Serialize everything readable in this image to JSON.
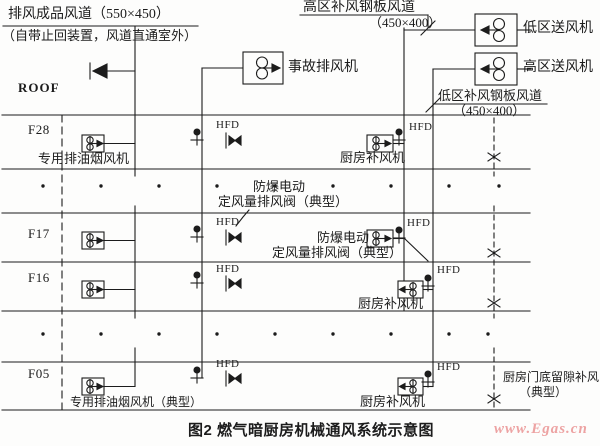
{
  "figure": {
    "caption": "图2  燃气暗厨房机械通风系统示意图",
    "watermark": "www.Egas.cn",
    "roof_label": "ROOF",
    "hfd_tag": "HFD",
    "floors": [
      "F28",
      "F17",
      "F16",
      "F05"
    ],
    "labels": {
      "exhaust_duct": "排风成品风道（550×450）",
      "exhaust_duct_note": "（自带止回装置，风道直通室外）",
      "high_zone_makeup_duct": "高区补风钢板风道",
      "high_zone_makeup_size": "（450×400）",
      "accident_exhaust_fan": "事故排风机",
      "low_zone_supply_fan": "低区送风机",
      "high_zone_supply_fan": "高区送风机",
      "low_zone_makeup_duct": "低区补风钢板风道",
      "low_zone_makeup_size": "（450×400）",
      "dedicated_smoke_exhaust_fan": "专用排油烟风机",
      "dedicated_smoke_exhaust_fan_typical": "专用排油烟风机（典型）",
      "kitchen_makeup_fan": "厨房补风机",
      "explosion_proof_electric": "防爆电动",
      "constant_volume_exhaust_valve_typical": "定风量排风阀（典型）",
      "door_gap_makeup": "厨房门底留隙补风",
      "door_gap_makeup_typical": "（典型）"
    },
    "colors": {
      "ink": "#1c1c1c",
      "watermark": "#eda3a3",
      "background": "#fdfdfc"
    }
  }
}
